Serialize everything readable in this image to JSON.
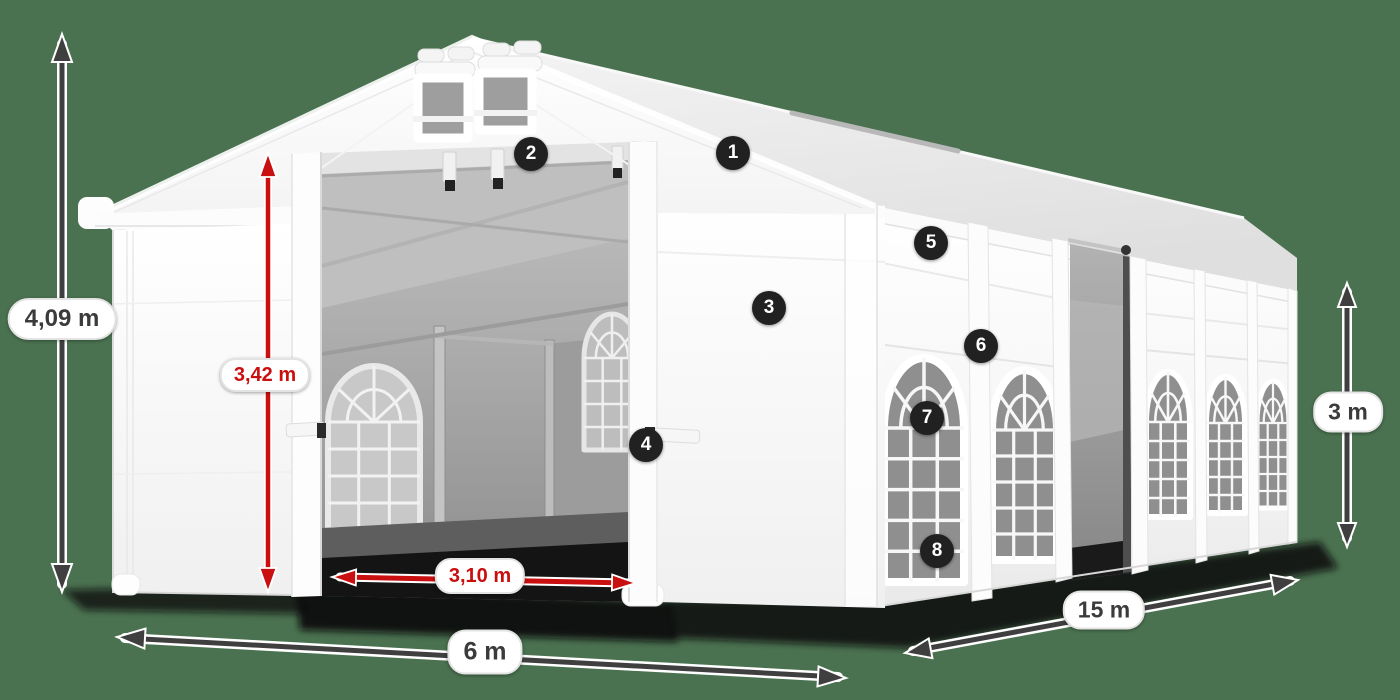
{
  "scene": {
    "background_color": "#4a7150",
    "subject": "white marquee tent product illustration with dimension arrows"
  },
  "dimension_labels": {
    "total_height": "4,09 m",
    "entrance_height": "3,42 m",
    "entrance_width": "3,10 m",
    "front_width": "6 m",
    "side_length": "15 m",
    "wall_height": "3 m"
  },
  "colors": {
    "arrow_dark": "#3f3f3f",
    "arrow_red": "#c90f0f",
    "label_text_dark": "#3b3b3b",
    "label_text_red": "#c90f0f",
    "marker_background": "#212121",
    "marker_text": "#ffffff",
    "tent_fabric": "#ffffff"
  },
  "markers": [
    {
      "label": "1"
    },
    {
      "label": "2"
    },
    {
      "label": "3"
    },
    {
      "label": "4"
    },
    {
      "label": "5"
    },
    {
      "label": "6"
    },
    {
      "label": "7"
    },
    {
      "label": "8"
    }
  ]
}
